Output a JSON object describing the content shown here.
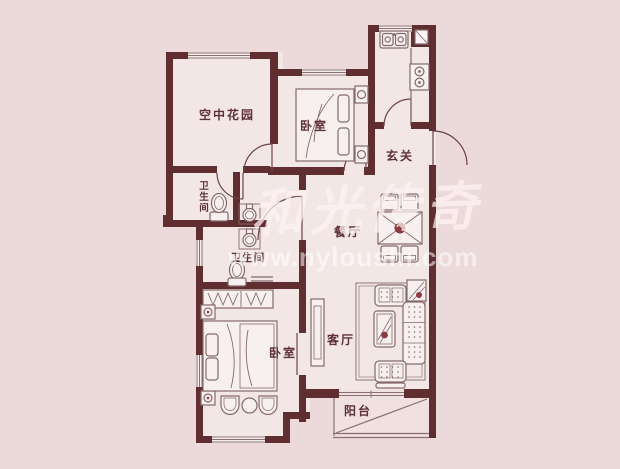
{
  "meta": {
    "type": "apartment-floor-plan",
    "colors": {
      "background": "#ecd9d9",
      "floor": "#f3e7e6",
      "balcony_floor": "#f0e1e0",
      "wall": "#602e31",
      "furniture_line": "#85696b",
      "label_text": "#5e3136",
      "accent_red": "#8c3a40"
    }
  },
  "rooms": {
    "sky_garden": {
      "label": "空中花园"
    },
    "bedroom_top": {
      "label": "卧室"
    },
    "entry_hall": {
      "label": "玄关"
    },
    "bathroom_1": {
      "label_chars": [
        "卫",
        "生",
        "间"
      ]
    },
    "dining_room": {
      "label": "餐厅"
    },
    "bathroom_2": {
      "label": "卫生间"
    },
    "bedroom_bottom": {
      "label": "卧室"
    },
    "living_room": {
      "label": "客厅"
    },
    "balcony": {
      "label": "阳台"
    }
  },
  "fixtures": [
    "kitchen-sink",
    "kitchen-stove",
    "double-bed",
    "nightstand",
    "dining-table",
    "dining-chair",
    "toilet",
    "washbasin",
    "wardrobe",
    "sofa",
    "armchair",
    "coffee-table",
    "tv-cabinet",
    "side-table",
    "tub-chair",
    "round-table"
  ],
  "watermark": {
    "calligraphy": "和光传奇",
    "url": "www.nyloushi.com"
  }
}
